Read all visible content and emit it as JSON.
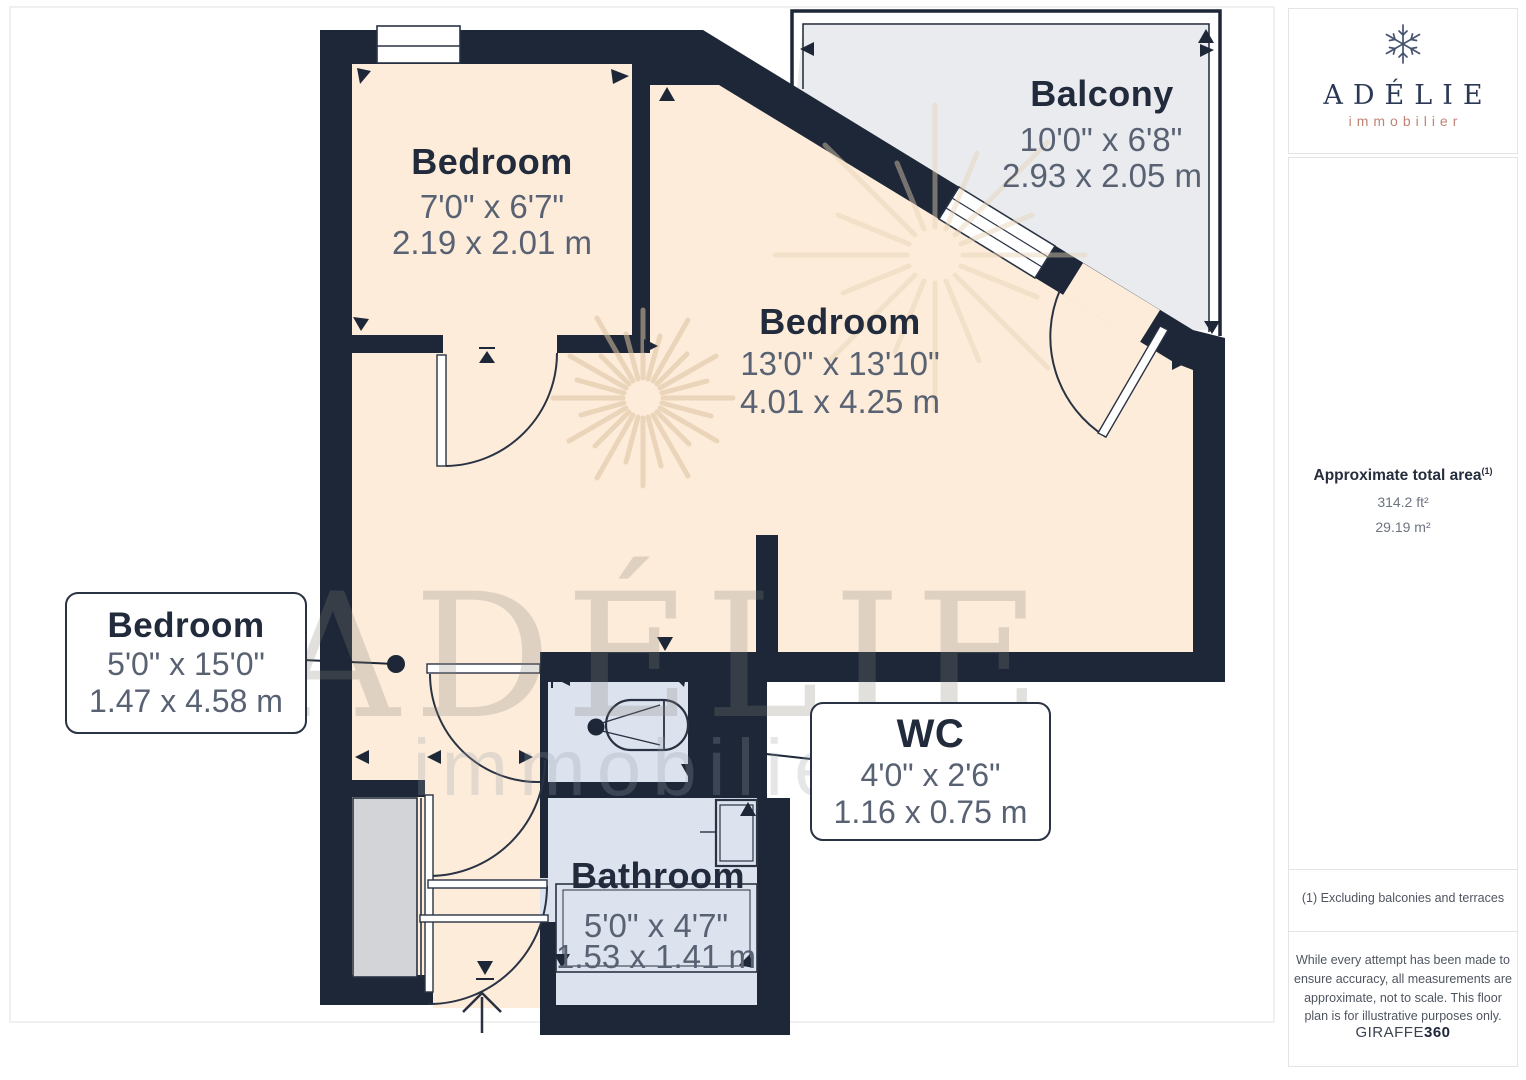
{
  "plan": {
    "rooms": {
      "bedroom_small": {
        "name": "Bedroom",
        "imperial": "7'0\" x 6'7\"",
        "metric": "2.19 x 2.01 m"
      },
      "balcony": {
        "name": "Balcony",
        "imperial": "10'0\" x 6'8\"",
        "metric": "2.93 x 2.05 m"
      },
      "bedroom_main": {
        "name": "Bedroom",
        "imperial": "13'0\" x 13'10\"",
        "metric": "4.01 x 4.25 m"
      },
      "bedroom_callout": {
        "name": "Bedroom",
        "imperial": "5'0\" x 15'0\"",
        "metric": "1.47 x 4.58 m"
      },
      "wc": {
        "name": "WC",
        "imperial": "4'0\" x 2'6\"",
        "metric": "1.16 x 0.75 m"
      },
      "bathroom": {
        "name": "Bathroom",
        "imperial": "5'0\" x 4'7\"",
        "metric": "1.53 x 1.41 m"
      }
    },
    "watermark": {
      "title": "ADÉLIE",
      "subtitle": "immobilier"
    }
  },
  "sidebar": {
    "brand": {
      "name": "ADÉLIE",
      "subtitle": "immobilier"
    },
    "area": {
      "title": "Approximate total area",
      "footnote_marker": "(1)",
      "imperial": "314.2 ft²",
      "metric": "29.19 m²"
    },
    "footnote": "(1) Excluding balconies and terraces",
    "disclaimer": "While every attempt has been made to ensure accuracy, all measurements are approximate, not to scale. This floor plan is for illustrative purposes only.",
    "credit": {
      "brand": "GIRAFFE",
      "suffix": "360"
    }
  },
  "colors": {
    "wall": "#1d2737",
    "floor": "#fdecda",
    "wet_room": "#dce2ee",
    "balcony": "#e9ebee",
    "accent_logo": "#c08374",
    "label_dark": "#212b3c",
    "label_gray": "#596273"
  }
}
